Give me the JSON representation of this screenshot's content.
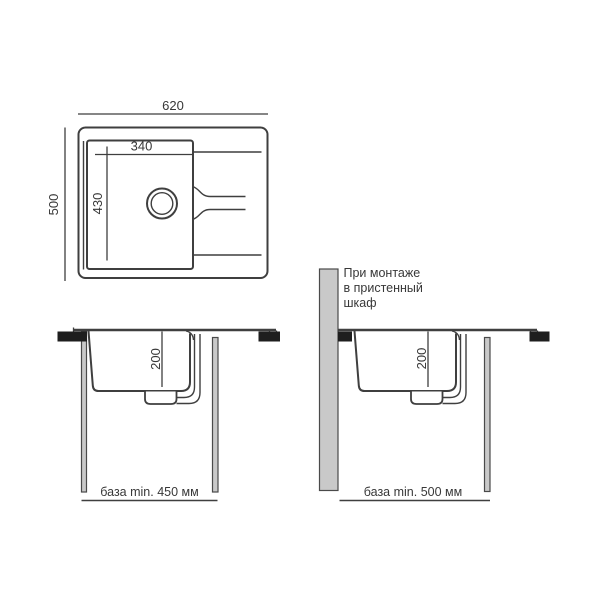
{
  "colors": {
    "background": "#ffffff",
    "line": "#3f3f3f",
    "text": "#383838",
    "clamp": "#1e1e1e",
    "panel_fill": "#c9c9c9",
    "panel_border": "#4a4a4a"
  },
  "top_view": {
    "overall_width": "620",
    "overall_depth": "500",
    "bowl_width": "340",
    "bowl_depth": "430"
  },
  "sections": {
    "left": {
      "bowl_depth": "200",
      "base_label": "база min. 450 мм"
    },
    "right": {
      "bowl_depth": "200",
      "base_label": "база min. 500 мм",
      "note_lines": [
        "При монтаже",
        "в пристенный",
        "шкаф"
      ]
    }
  }
}
